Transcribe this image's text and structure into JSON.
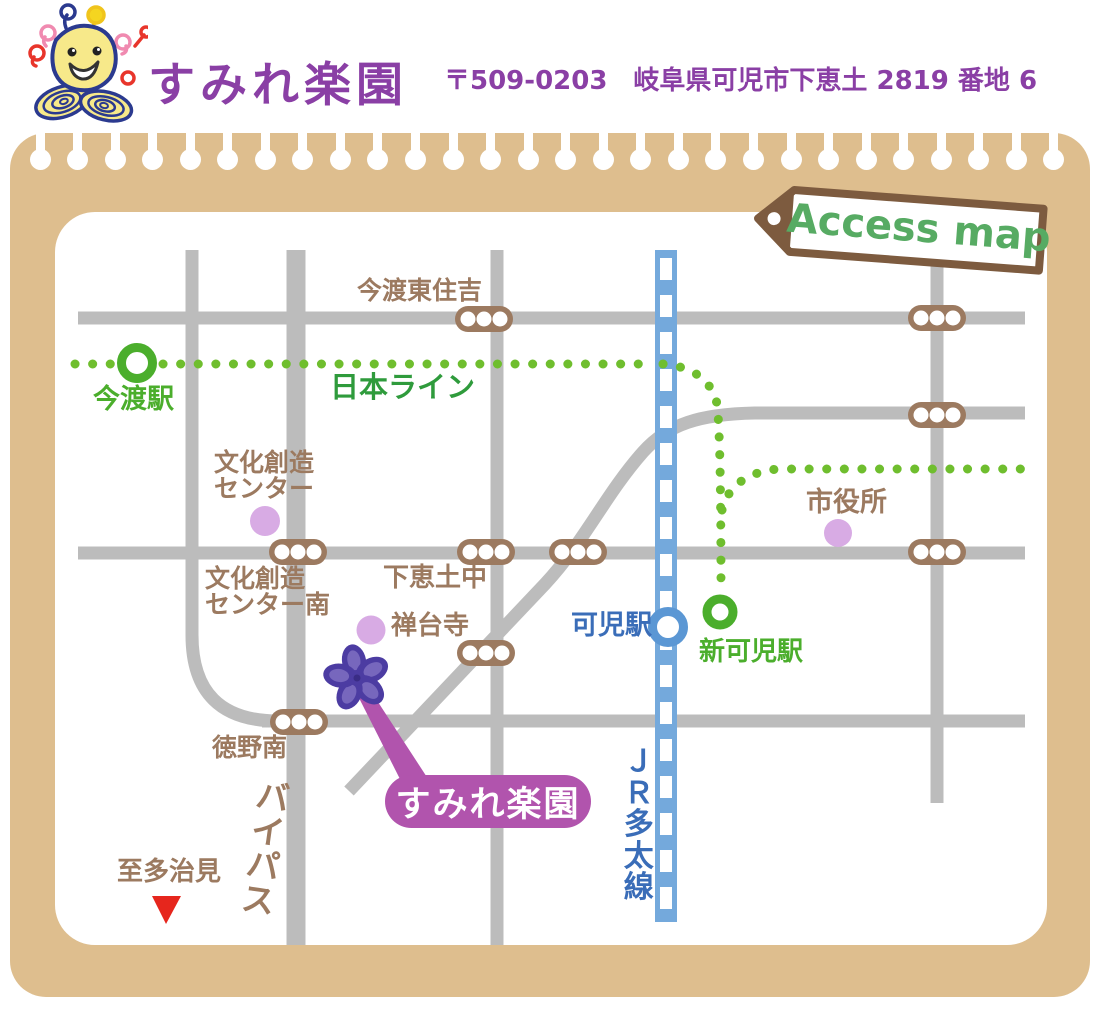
{
  "header": {
    "title": "すみれ楽園",
    "address": "〒509-0203　岐阜県可児市下恵土 2819 番地 6",
    "mascot": "bee-flower-mascot"
  },
  "map": {
    "tag_label": "Access map",
    "labels": {
      "imawatari_higashi_sumiyoshi": "今渡東住吉",
      "nihon_line": "日本ライン",
      "imawatari_station": "今渡駅",
      "bunka_center_line1": "文化創造",
      "bunka_center_line2": "センター",
      "bunka_center_minami_line1": "文化創造",
      "bunka_center_minami_line2": "センター南",
      "shimoedo_junior_high": "下恵土中",
      "zendaiji_temple": "禅台寺",
      "kani_station": "可児駅",
      "shin_kani_station": "新可児駅",
      "city_hall": "市役所",
      "tokuno_minami": "徳野南",
      "bypass": "バイパス",
      "to_tajimi": "至多治見",
      "jr_taita_line": "ＪＲ多太線",
      "sumire_rakuen": "すみれ楽園"
    },
    "legend_icons": {
      "traffic_light": "brown capsule with three white lamps",
      "station_marker_green": "green ring",
      "station_marker_blue": "blue ring",
      "landmark": "lavender dot",
      "destination_flower": "purple violet flower"
    }
  },
  "colors": {
    "accent_purple": "#8a3fa5",
    "board_tan": "#debe8e",
    "road_gray": "#bcbcbc",
    "label_brown": "#9c7a60",
    "line_green": "#6fbe2e",
    "text_green_dark": "#2f9b3c",
    "station_green": "#4bae2c",
    "rail_blue": "#74a9dc",
    "rail_text_blue": "#3a6db8",
    "landmark_lavender": "#d8abe4",
    "pill_purple": "#b154ad",
    "flower_purple": "#4c3ca2",
    "tag_brown": "#7d5b3f",
    "tag_green": "#57ab63",
    "arrow_red": "#e6261d"
  }
}
